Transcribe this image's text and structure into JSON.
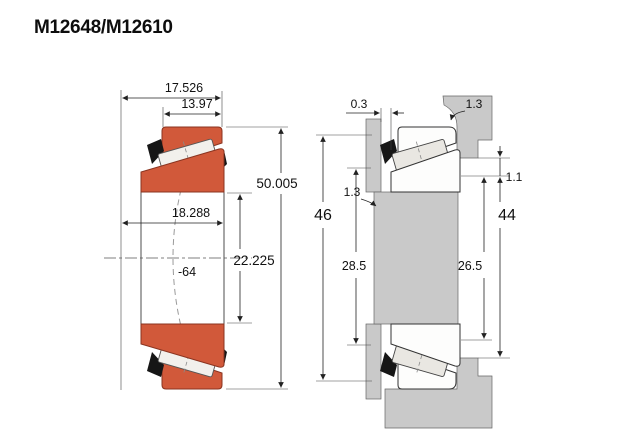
{
  "title": "M12648/M12610",
  "left_view": {
    "description": "tapered roller bearing cross-section",
    "dims": {
      "overall_width": "17.526",
      "cup_width": "13.97",
      "outer_diameter": "50.005",
      "cone_width": "18.288",
      "bore_diameter": "22.225",
      "apex_note": "-64"
    }
  },
  "right_view": {
    "description": "shaft and housing mounting dimensions",
    "dims": {
      "backface_gap": "0.3",
      "housing_fillet": "1.3",
      "shaft_fillet": "1.3",
      "step": "1.1",
      "outer_abutment": "46",
      "shaft_shoulder": "28.5",
      "housing_shoulder": "44",
      "inner_abutment": "26.5"
    }
  },
  "colors": {
    "ring_orange": "#d1593a",
    "steel_gray": "#c9c9c9",
    "roller_light": "#f2f0ec",
    "cage_black": "#161616"
  }
}
